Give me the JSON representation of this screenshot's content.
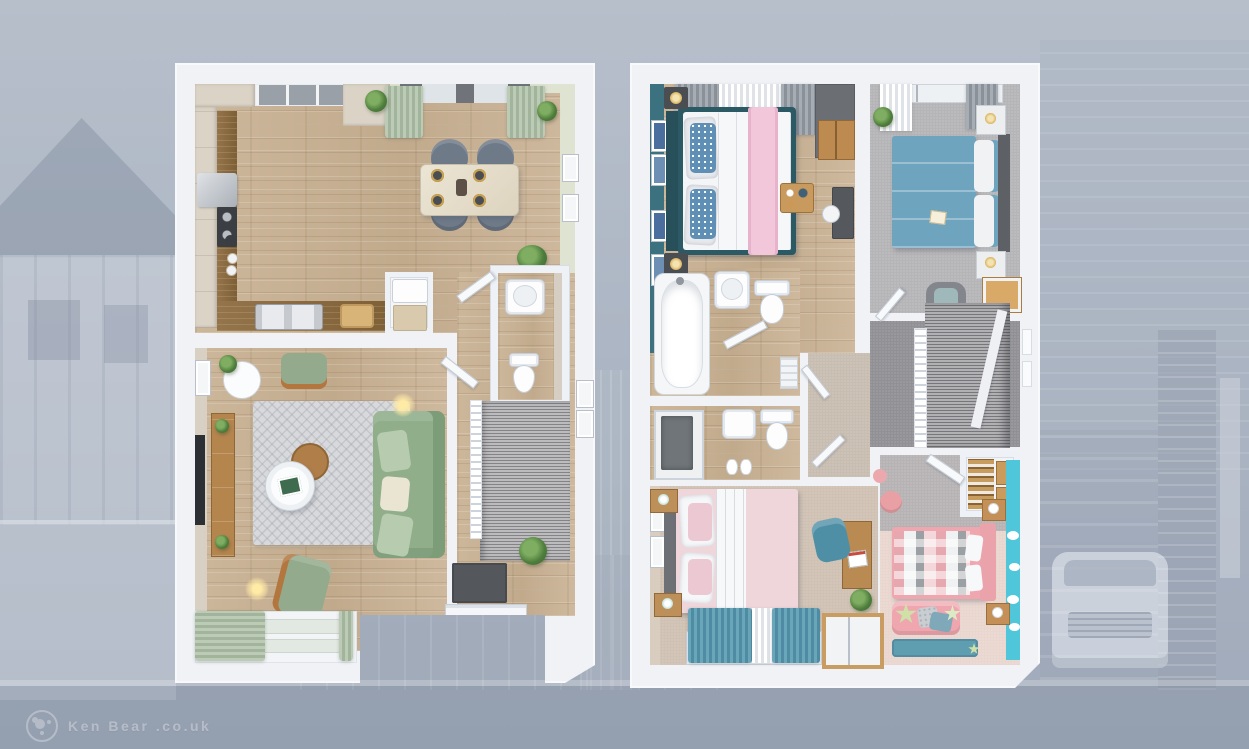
{
  "meta": {
    "scene": "3D dollhouse-style floor plan render of a two-storey house, two plans side by side over a faded blue-grey street photograph",
    "left_plan": "Ground Floor",
    "right_plan": "First Floor"
  },
  "watermark": {
    "logo": "bear-paw-logo",
    "text": "Ken Bear .co.uk"
  },
  "background": {
    "wash_color": "#aab4c2",
    "elements": [
      "detached-house-gable-left",
      "timber-frame-facade",
      "garden-wall",
      "house-facade-right",
      "brick-pillar",
      "garage-door",
      "parked-white-car",
      "driveway",
      "kerb-and-road"
    ]
  },
  "palette": {
    "plan_frame_white": "#f0f2f6",
    "wood_floor": "#c9b298",
    "worktop_oak": "#8a6b40",
    "cabinet_cream": "#dad3c6",
    "sage_curtain": "#aebfa8",
    "dining_chair_grey": "#6f7a89",
    "sofa_green": "#8fae89",
    "rug_grey": "#d8d9dc",
    "doormat_grey": "#54585d",
    "stair_carpet": "#9c9b9e",
    "teal_feature_wall": "#3c7280",
    "bed1_frame_teal": "#2b5a64",
    "pillow_blue": "#5f8fb4",
    "throw_pink": "#f3c7da",
    "bed2_duvet_blue": "#6ea4be",
    "carpet_grey": "#b5b4b6",
    "landing_carpet": "#919094",
    "carpet_beige": "#cfc1b3",
    "bed3_duvet_pink": "#eed6db",
    "teal_curtain": "#5f9db4",
    "bed4_pink": "#efa6ae",
    "cyan_feature_wall": "#4fc6da",
    "rug_teal": "#5f9db0",
    "lamp_gold": "#d9b25e",
    "wardrobe_oak": "#bd8a50"
  },
  "plans": [
    {
      "name": "Ground Floor",
      "position": "left",
      "rooms": [
        {
          "name": "kitchen",
          "floor": "oak-laminate",
          "items": [
            "wall-cabinets",
            "tall-unit",
            "base-units",
            "oak-worktop",
            "extractor-hood",
            "hob",
            "kettle",
            "plates",
            "double-sink",
            "chopping-board",
            "window"
          ]
        },
        {
          "name": "dining-area",
          "floor": "oak-laminate",
          "wall": "pale-sage",
          "items": [
            "glass-top-table",
            "tub-chair x4",
            "place-setting x4",
            "window",
            "sage-curtains x2",
            "hanging-plant x2",
            "botanical-print x2",
            "potted-plant"
          ]
        },
        {
          "name": "living-room",
          "floor": "oak-laminate",
          "items": [
            "green-sofa",
            "scatter-cushions x3",
            "green-armchair x2",
            "round-coffee-table",
            "round-side-table",
            "tv-unit",
            "wall-tv",
            "patterned-rug",
            "floor-lamp x2",
            "lamp-table-with-plant",
            "bay-window",
            "sage-curtains"
          ]
        },
        {
          "name": "hallway",
          "floor": "oak-laminate",
          "items": [
            "staircase",
            "white-balustrade",
            "front-door",
            "dark-doormat",
            "potted-plant",
            "open-door x2",
            "picture-frame x2"
          ]
        },
        {
          "name": "wc",
          "floor": "oak-laminate",
          "items": [
            "basin",
            "toilet"
          ]
        },
        {
          "name": "store-cupboard",
          "items": [
            "white-appliance",
            "storage-boxes"
          ]
        }
      ]
    },
    {
      "name": "First Floor",
      "position": "right",
      "rooms": [
        {
          "name": "bedroom-1",
          "floor": "oak-laminate",
          "wall": "teal-feature",
          "items": [
            "double-bed-teal-frame",
            "blue-patterned-pillows",
            "white-duvet",
            "pink-throw",
            "breakfast-tray",
            "bedside-table x2",
            "gold-lamp x2",
            "gallery-frame x4",
            "wardrobe-oak",
            "tall-grey-cabinet",
            "desk",
            "desk-chair",
            "curtains"
          ]
        },
        {
          "name": "bedroom-2",
          "floor": "grey-carpet",
          "items": [
            "double-bed-blue-duvet",
            "grey-headboard",
            "white-pillows",
            "bedside-chest x2",
            "gold-lamp x2",
            "dresser-wood-top",
            "grey-armchair",
            "plant",
            "window-curtains",
            "magazine"
          ]
        },
        {
          "name": "bathroom",
          "floor": "oak-laminate",
          "items": [
            "bath",
            "basin",
            "toilet",
            "towel-shelf"
          ]
        },
        {
          "name": "en-suite",
          "floor": "oak-laminate",
          "items": [
            "shower-enclosure",
            "basin",
            "toilet",
            "slippers"
          ]
        },
        {
          "name": "bedroom-3",
          "floor": "beige-carpet",
          "items": [
            "double-bed-pink-duvet",
            "white-pillows",
            "bedside-table x2",
            "mint-lamp x2",
            "teal-curtains",
            "sheer-curtain",
            "desk-oak",
            "red-book",
            "teal-desk-chair",
            "plant",
            "wardrobe",
            "wall-art x2"
          ]
        },
        {
          "name": "bedroom-4",
          "floor": "grey-and-pink-carpet",
          "wall": "cyan-feature",
          "items": [
            "bed-checked-duvet",
            "pink-headboard",
            "white-pillows",
            "bedside-unit x2",
            "pink-sofa",
            "star-cushion x2",
            "grey-cushion",
            "teal-cushion",
            "teal-rug",
            "cloud-decals",
            "pink-pouf x2"
          ]
        },
        {
          "name": "landing",
          "floor": "dark-grey-carpet",
          "items": [
            "staircase-down",
            "white-spindle-balustrade",
            "window-slots",
            "open-door x3"
          ]
        },
        {
          "name": "airing-cupboard",
          "items": [
            "slatted-oak-shelves",
            "storage-boxes"
          ]
        }
      ]
    }
  ]
}
